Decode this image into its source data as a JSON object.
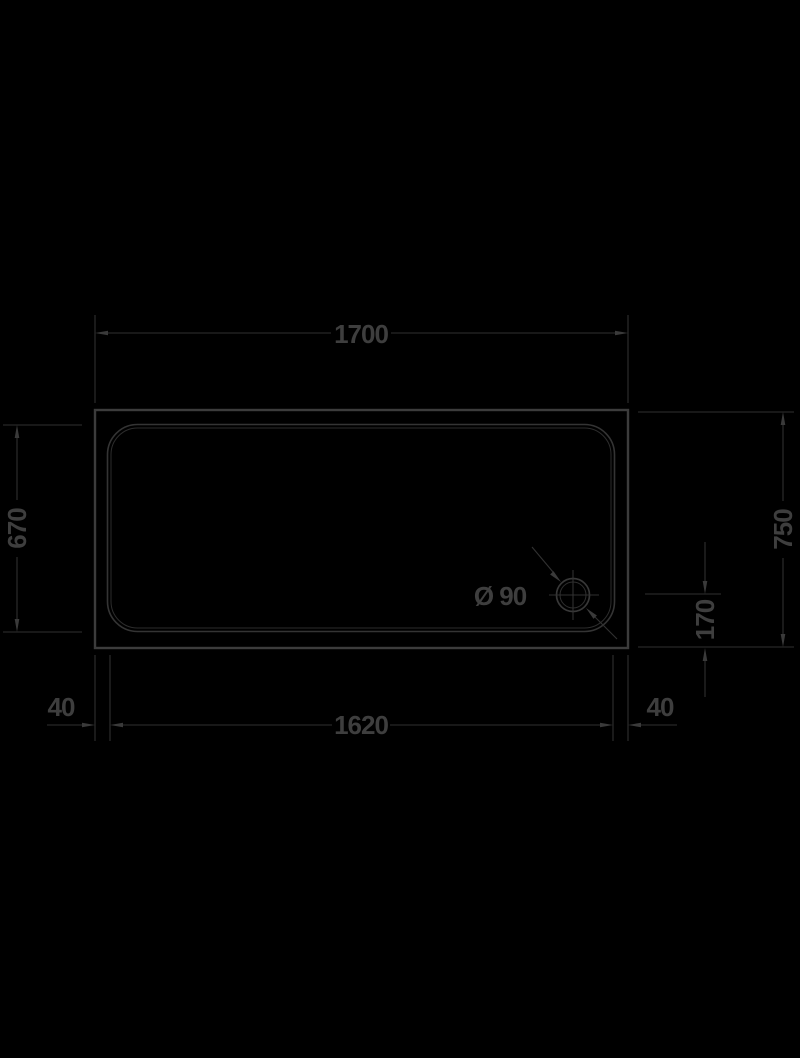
{
  "dimensions": {
    "overall_width": "1700",
    "overall_depth": "750",
    "inner_depth": "670",
    "inner_width": "1620",
    "rim_left": "40",
    "rim_right": "40",
    "drain_offset": "170",
    "drain_diameter": "Ø 90"
  },
  "colors": {
    "background": "#000000",
    "outline": "#3c3c3c",
    "dimension_lines": "#313131",
    "text": "#3e3e3e"
  }
}
